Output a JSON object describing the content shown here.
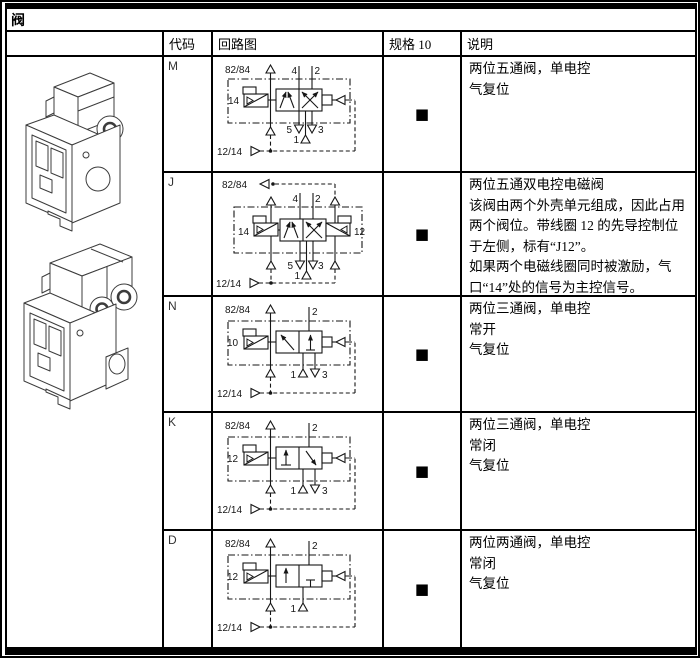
{
  "table": {
    "title": "阀",
    "headers": {
      "code": "代码",
      "circuit": "回路图",
      "spec": "规格 10",
      "desc": "说明"
    },
    "spec_marker": "■",
    "rows": [
      {
        "code": "M",
        "desc": [
          "两位五通阀，单电控",
          "气复位"
        ],
        "diagram": {
          "type": "5/2-single-solenoid",
          "pilot_top": "82/84",
          "pilot_bottom": "12/14",
          "left_port": "14",
          "top_ports": [
            "4",
            "2"
          ],
          "bottom_ports": [
            "5",
            "1",
            "3"
          ]
        }
      },
      {
        "code": "J",
        "desc": [
          "两位五通双电控电磁阀",
          "该阀由两个外壳单元组成，因此占用两个阀位。带线圈 12 的先导控制位于左侧，标有“J12”。",
          "如果两个电磁线圈同时被激励，气口“14”处的信号为主控信号。"
        ],
        "diagram": {
          "type": "5/2-double-solenoid",
          "pilot_top": "82/84",
          "pilot_bottom": "12/14",
          "left_port": "14",
          "right_port": "12",
          "top_ports": [
            "4",
            "2"
          ],
          "bottom_ports": [
            "5",
            "1",
            "3"
          ]
        }
      },
      {
        "code": "N",
        "desc": [
          "两位三通阀，单电控",
          "常开",
          "气复位"
        ],
        "diagram": {
          "type": "3/2-normally-open",
          "pilot_top": "82/84",
          "pilot_bottom": "12/14",
          "left_port": "10",
          "top_ports": [
            "2"
          ],
          "bottom_ports": [
            "1",
            "3"
          ]
        }
      },
      {
        "code": "K",
        "desc": [
          "两位三通阀，单电控",
          "常闭",
          "气复位"
        ],
        "diagram": {
          "type": "3/2-normally-closed",
          "pilot_top": "82/84",
          "pilot_bottom": "12/14",
          "left_port": "12",
          "top_ports": [
            "2"
          ],
          "bottom_ports": [
            "1",
            "3"
          ]
        }
      },
      {
        "code": "D",
        "desc": [
          "两位两通阀，单电控",
          "常闭",
          "气复位"
        ],
        "diagram": {
          "type": "2/2-normally-closed",
          "pilot_top": "82/84",
          "pilot_bottom": "12/14",
          "left_port": "12",
          "top_ports": [
            "2"
          ],
          "bottom_ports": [
            "1"
          ]
        }
      }
    ]
  },
  "colors": {
    "title_bg": "#b7d6e9",
    "header_bg": "#d5e9f5",
    "spec_cell_bg": "#d9d9d9",
    "grid": "#000000"
  }
}
